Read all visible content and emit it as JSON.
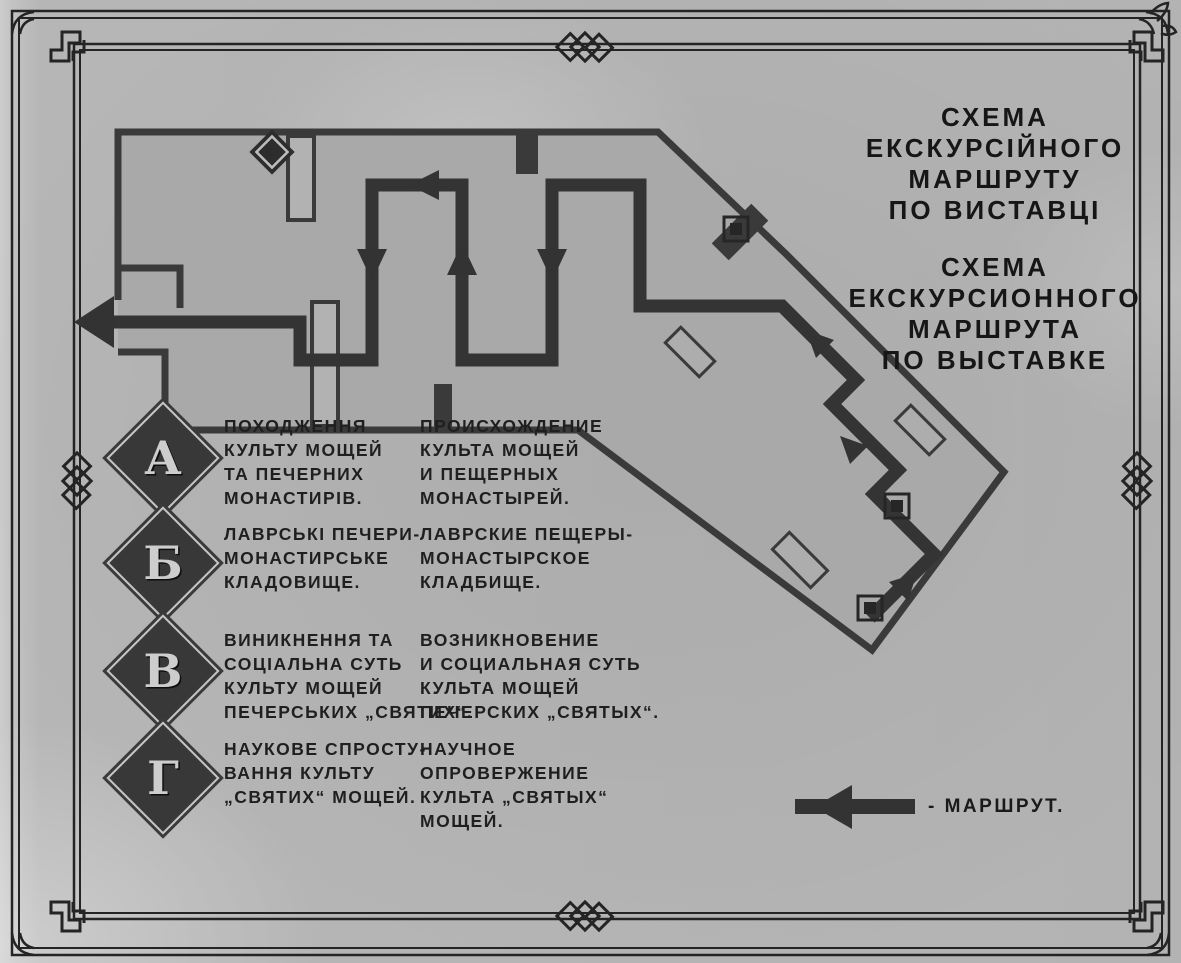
{
  "photo": {
    "kind": "museum exhibition route scheme board (photograph)",
    "title_ua": {
      "lines": [
        "СХЕМА",
        "ЕКСКУРСІЙНОГО",
        "МАРШРУТУ",
        "ПО ВИСТАВЦІ"
      ]
    },
    "title_ru": {
      "lines": [
        "СХЕМА",
        "ЕКСКУРСИОННОГО",
        "МАРШРУТА",
        "ПО ВЫСТАВКЕ"
      ]
    },
    "legend": {
      "items": [
        {
          "letter": "А",
          "ua_lines": [
            "ПОХОДЖЕННЯ",
            "КУЛЬТУ МОЩЕЙ",
            "ТА ПЕЧЕРНИХ",
            "МОНАСТИРІВ."
          ],
          "ru_lines": [
            "ПРОИСХОЖДЕНИЕ",
            "КУЛЬТА МОЩЕЙ",
            "И ПЕЩЕРНЫХ",
            "МОНАСТЫРЕЙ."
          ]
        },
        {
          "letter": "Б",
          "ua_lines": [
            "ЛАВРСЬКІ ПЕЧЕРИ-",
            "МОНАСТИРСЬКЕ",
            "КЛАДОВИЩЕ."
          ],
          "ru_lines": [
            "ЛАВРСКИЕ ПЕЩЕРЫ-",
            "МОНАСТЫРСКОЕ",
            "КЛАДБИЩЕ."
          ]
        },
        {
          "letter": "В",
          "ua_lines": [
            "ВИНИКНЕННЯ ТА",
            "СОЦІАЛЬНА СУТЬ",
            "КУЛЬТУ МОЩЕЙ",
            "ПЕЧЕРСЬКИХ „СВЯТИХ“."
          ],
          "ru_lines": [
            "ВОЗНИКНОВЕНИЕ",
            "И СОЦИАЛЬНАЯ СУТЬ",
            "КУЛЬТА МОЩЕЙ",
            "ПЕЧЕРСКИХ „СВЯТЫХ“."
          ]
        },
        {
          "letter": "Г",
          "ua_lines": [
            "НАУКОВЕ СПРОСТУ-",
            "ВАННЯ КУЛЬТУ",
            "„СВЯТИХ“ МОЩЕЙ."
          ],
          "ru_lines": [
            "НАУЧНОЕ",
            "ОПРОВЕРЖЕНИЕ",
            "КУЛЬТА „СВЯТЫХ“",
            "МОЩЕЙ."
          ]
        }
      ]
    },
    "route_legend": {
      "label": "- МАРШРУТ."
    },
    "map": {
      "route_arrow_count": 8,
      "exhibit_markers": [
        "diamond-marker",
        "square-marker",
        "square-marker",
        "square-marker"
      ]
    },
    "colors": {
      "paper": "#b5b5b5",
      "ink": "#1a1a1a",
      "plan_fill": "#a9a9a9",
      "wall": "#3a3a3a",
      "route": "#343434",
      "frame": "#242424",
      "badge_fill": "#383838",
      "badge_letter": "#cdcdcd"
    }
  }
}
